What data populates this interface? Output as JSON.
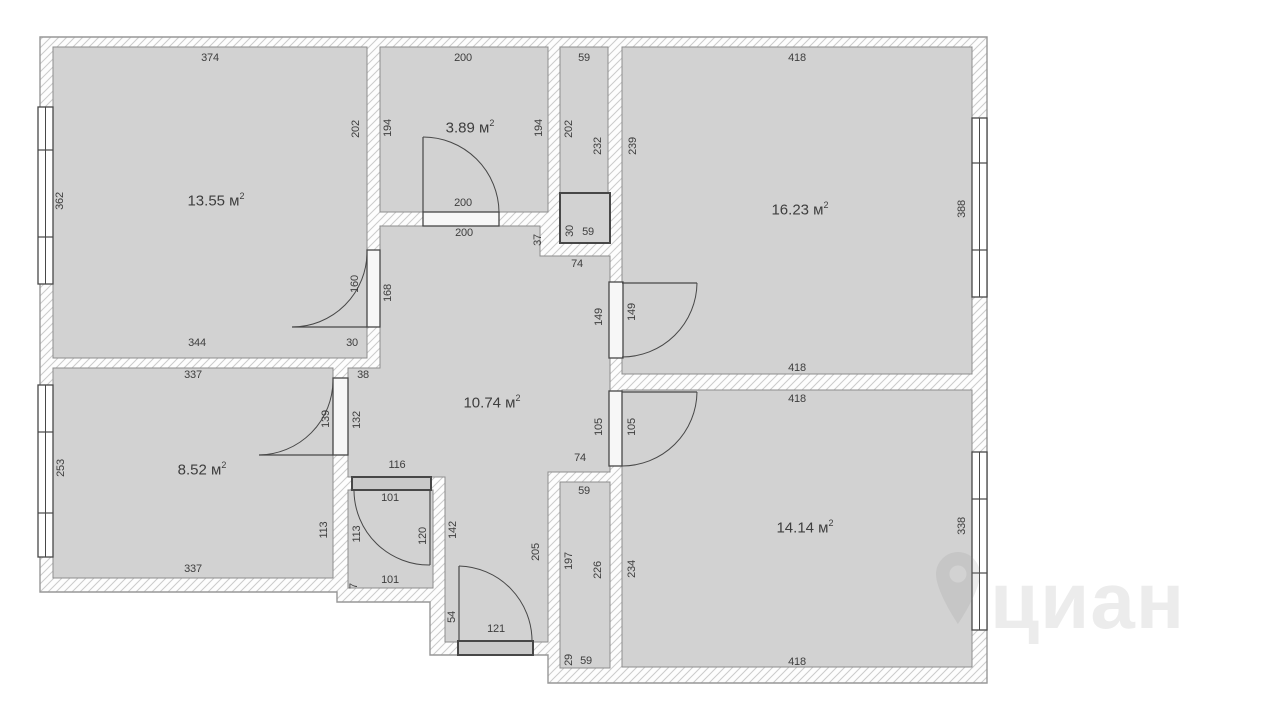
{
  "watermark": {
    "text": "циан"
  },
  "floorplan": {
    "colors": {
      "room_fill": "#d2d2d2",
      "room_edge": "#8d8d8d",
      "wall_outline": "#979797",
      "hatch_line": "#cbcbcb",
      "dark": "#474747",
      "door_fill_light": "#f7f7f7",
      "door_fill_dark": "#c9c9c9",
      "text": "#3e3e3e",
      "watermark_color": "#8c8c8c"
    },
    "outer_path": "M40,37 L987,37 L987,683 L548,683 L548,655 L430,655 L430,602 L337,602 L337,592 L40,592 Z",
    "spaces": [
      {
        "name": "room-13-55",
        "rect": [
          53,
          47,
          314,
          311
        ]
      },
      {
        "name": "room-3-89",
        "rect": [
          380,
          47,
          168,
          165
        ]
      },
      {
        "name": "room-16-23",
        "rect": [
          622,
          47,
          350,
          327
        ]
      },
      {
        "name": "room-14-14",
        "rect": [
          622,
          390,
          350,
          277
        ]
      },
      {
        "name": "room-8-52",
        "rect": [
          53,
          368,
          280,
          210
        ]
      },
      {
        "name": "bathroom",
        "rect": [
          348,
          490,
          85,
          98
        ]
      },
      {
        "name": "duct-top",
        "rect": [
          560,
          47,
          48,
          146
        ]
      },
      {
        "name": "duct-bottom",
        "rect": [
          560,
          482,
          50,
          186
        ]
      },
      {
        "name": "hallway",
        "path": "M380,226 L540,226 L540,256 L610,256 L610,472 L548,472 L548,642 L445,642 L445,477 L348,477 L348,368 L380,368 Z"
      }
    ],
    "boxes": [
      {
        "name": "duct-box",
        "rect": [
          560,
          193,
          50,
          50
        ]
      }
    ],
    "windows": [
      {
        "name": "window-room-13-55",
        "rect": [
          38,
          107,
          15,
          177
        ],
        "dividers": [
          150,
          237
        ]
      },
      {
        "name": "window-room-8-52",
        "rect": [
          38,
          385,
          15,
          172
        ],
        "dividers": [
          432,
          513
        ]
      },
      {
        "name": "window-room-16-23",
        "rect": [
          972,
          118,
          15,
          179
        ],
        "dividers": [
          163,
          250
        ]
      },
      {
        "name": "window-room-14-14",
        "rect": [
          972,
          452,
          15,
          178
        ],
        "dividers": [
          499,
          573
        ]
      }
    ],
    "doors": [
      {
        "name": "door-room-13-55",
        "style": "light",
        "rect": [
          367,
          250,
          13,
          77
        ],
        "leaf": "M292,327 L367,327",
        "arc": "M292,327 A75 75 0 0 0 367,252"
      },
      {
        "name": "door-room-3-89",
        "style": "light",
        "rect": [
          423,
          212,
          76,
          14
        ],
        "leaf": "M423,137 L423,212",
        "arc": "M423,137 A76 76 0 0 1 499,212"
      },
      {
        "name": "door-room-8-52",
        "style": "light",
        "rect": [
          333,
          378,
          15,
          77
        ],
        "leaf": "M259,455 L333,455",
        "arc": "M259,455 A75 75 0 0 0 333,380"
      },
      {
        "name": "door-room-16-23",
        "style": "light",
        "rect": [
          609,
          282,
          14,
          76
        ],
        "leaf": "M622,283 L697,283",
        "arc": "M697,283 A75 75 0 0 1 622,357"
      },
      {
        "name": "door-room-14-14",
        "style": "light",
        "rect": [
          609,
          391,
          13,
          75
        ],
        "leaf": "M622,392 L697,392",
        "arc": "M697,392 A75 75 0 0 1 622,466"
      },
      {
        "name": "door-bathroom",
        "style": "dark",
        "rect": [
          352,
          477,
          79,
          13
        ],
        "leaf": "M430,491 L430,565",
        "arc": "M430,565 A75 75 0 0 1 354,491"
      },
      {
        "name": "door-entrance",
        "style": "dark",
        "rect": [
          458,
          641,
          75,
          14
        ],
        "leaf": "M459,566 L459,641",
        "arc": "M459,566 A75 75 0 0 1 532,641"
      }
    ],
    "area_unit": {
      "base": "м",
      "sup": "2"
    },
    "area_labels": [
      {
        "value": "13.55",
        "x": 216,
        "y": 201
      },
      {
        "value": "3.89",
        "x": 470,
        "y": 128
      },
      {
        "value": "16.23",
        "x": 800,
        "y": 210
      },
      {
        "value": "10.74",
        "x": 492,
        "y": 403
      },
      {
        "value": "8.52",
        "x": 202,
        "y": 470
      },
      {
        "value": "14.14",
        "x": 805,
        "y": 528
      }
    ],
    "dim_labels": [
      {
        "t": "374",
        "x": 210,
        "y": 58,
        "r": 0
      },
      {
        "t": "362",
        "x": 60,
        "y": 201,
        "r": -90
      },
      {
        "t": "202",
        "x": 356,
        "y": 129,
        "r": -90
      },
      {
        "t": "344",
        "x": 197,
        "y": 343,
        "r": 0
      },
      {
        "t": "30",
        "x": 352,
        "y": 343,
        "r": 0
      },
      {
        "t": "160",
        "x": 355,
        "y": 284,
        "r": -90
      },
      {
        "t": "168",
        "x": 388,
        "y": 293,
        "r": -90
      },
      {
        "t": "200",
        "x": 463,
        "y": 58,
        "r": 0
      },
      {
        "t": "194",
        "x": 388,
        "y": 128,
        "r": -90
      },
      {
        "t": "194",
        "x": 539,
        "y": 128,
        "r": -90
      },
      {
        "t": "200",
        "x": 463,
        "y": 203,
        "r": 0
      },
      {
        "t": "200",
        "x": 464,
        "y": 233,
        "r": 0
      },
      {
        "t": "59",
        "x": 584,
        "y": 58,
        "r": 0
      },
      {
        "t": "202",
        "x": 569,
        "y": 129,
        "r": -90
      },
      {
        "t": "232",
        "x": 598,
        "y": 146,
        "r": -90
      },
      {
        "t": "30",
        "x": 570,
        "y": 231,
        "r": -90
      },
      {
        "t": "59",
        "x": 588,
        "y": 232,
        "r": 0
      },
      {
        "t": "74",
        "x": 577,
        "y": 264,
        "r": 0
      },
      {
        "t": "239",
        "x": 633,
        "y": 146,
        "r": -90
      },
      {
        "t": "418",
        "x": 797,
        "y": 58,
        "r": 0
      },
      {
        "t": "388",
        "x": 962,
        "y": 209,
        "r": -90
      },
      {
        "t": "418",
        "x": 797,
        "y": 368,
        "r": 0
      },
      {
        "t": "37",
        "x": 538,
        "y": 240,
        "r": -90
      },
      {
        "t": "149",
        "x": 599,
        "y": 317,
        "r": -90
      },
      {
        "t": "149",
        "x": 632,
        "y": 312,
        "r": -90
      },
      {
        "t": "105",
        "x": 599,
        "y": 427,
        "r": -90
      },
      {
        "t": "105",
        "x": 632,
        "y": 427,
        "r": -90
      },
      {
        "t": "74",
        "x": 580,
        "y": 458,
        "r": 0
      },
      {
        "t": "38",
        "x": 363,
        "y": 375,
        "r": 0
      },
      {
        "t": "132",
        "x": 357,
        "y": 420,
        "r": -90
      },
      {
        "t": "139",
        "x": 326,
        "y": 419,
        "r": -90
      },
      {
        "t": "337",
        "x": 193,
        "y": 375,
        "r": 0
      },
      {
        "t": "253",
        "x": 61,
        "y": 468,
        "r": -90
      },
      {
        "t": "113",
        "x": 324,
        "y": 530,
        "r": -90
      },
      {
        "t": "337",
        "x": 193,
        "y": 569,
        "r": 0
      },
      {
        "t": "116",
        "x": 397,
        "y": 465,
        "r": 0
      },
      {
        "t": "101",
        "x": 390,
        "y": 498,
        "r": 0
      },
      {
        "t": "113",
        "x": 357,
        "y": 534,
        "r": -90
      },
      {
        "t": "120",
        "x": 423,
        "y": 536,
        "r": -90
      },
      {
        "t": "101",
        "x": 390,
        "y": 580,
        "r": 0
      },
      {
        "t": "7",
        "x": 354,
        "y": 586,
        "r": -90
      },
      {
        "t": "142",
        "x": 453,
        "y": 530,
        "r": -90
      },
      {
        "t": "205",
        "x": 536,
        "y": 552,
        "r": -90
      },
      {
        "t": "54",
        "x": 452,
        "y": 617,
        "r": -90
      },
      {
        "t": "121",
        "x": 496,
        "y": 629,
        "r": 0
      },
      {
        "t": "59",
        "x": 584,
        "y": 491,
        "r": 0
      },
      {
        "t": "197",
        "x": 569,
        "y": 561,
        "r": -90
      },
      {
        "t": "226",
        "x": 598,
        "y": 570,
        "r": -90
      },
      {
        "t": "29",
        "x": 569,
        "y": 660,
        "r": -90
      },
      {
        "t": "59",
        "x": 586,
        "y": 661,
        "r": 0
      },
      {
        "t": "418",
        "x": 797,
        "y": 399,
        "r": 0
      },
      {
        "t": "234",
        "x": 632,
        "y": 569,
        "r": -90
      },
      {
        "t": "338",
        "x": 962,
        "y": 526,
        "r": -90
      },
      {
        "t": "418",
        "x": 797,
        "y": 662,
        "r": 0
      }
    ]
  }
}
